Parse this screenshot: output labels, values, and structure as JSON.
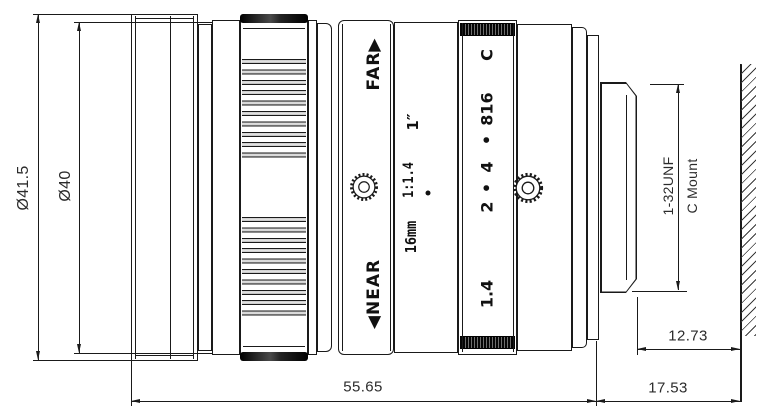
{
  "style": {
    "ink_color": "#1a1a1a",
    "background": "#ffffff"
  },
  "dimensions": {
    "front_diameter": "Ø41.5",
    "barrel_diameter": "Ø40",
    "body_length": "55.65",
    "rear_length": "17.53",
    "thread_length": "12.73"
  },
  "mount": {
    "thread_spec": "1-32UNF",
    "mount_type": "C Mount"
  },
  "focus_ring": {
    "far_label": "FAR",
    "far_arrow": "▶",
    "near_label": "NEAR",
    "near_arrow": "◀"
  },
  "barrel_markings": {
    "focal_length": "16mm",
    "aperture_ratio": "1:1.4",
    "sensor_format": "1″",
    "index_dot": "●"
  },
  "aperture_ring": {
    "labels": [
      "C",
      "816",
      "•",
      "4",
      "•",
      "2",
      "1.4"
    ]
  },
  "icons": {
    "focus_lock": "thumbscrew-gear-icon",
    "aperture_lock": "thumbscrew-gear-icon"
  }
}
